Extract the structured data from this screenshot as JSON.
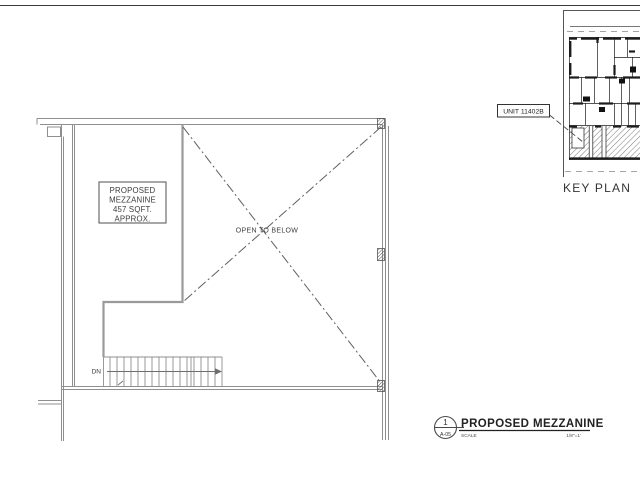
{
  "sheet": {
    "plan_labels": {
      "mezzanine_box": [
        "PROPOSED",
        "MEZZANINE",
        "457 SQFT.",
        "APPROX."
      ],
      "open_to_below": "OPEN TO BELOW",
      "down": "DN"
    },
    "key_plan": {
      "label": "KEY PLAN",
      "unit_tag": "UNIT 11402B"
    },
    "title_block": {
      "detail_number": "1",
      "sheet_ref": "A-05",
      "title": "PROPOSED MEZZANINE",
      "scale_label": "SCALE",
      "scale_value": "1/8\"=1'"
    },
    "colors": {
      "wall_line": "#8f8f8f",
      "edge_line": "#9a9a9a",
      "dark_line": "#3a3a3a",
      "keyplan_line": "#1c1c1c"
    }
  }
}
